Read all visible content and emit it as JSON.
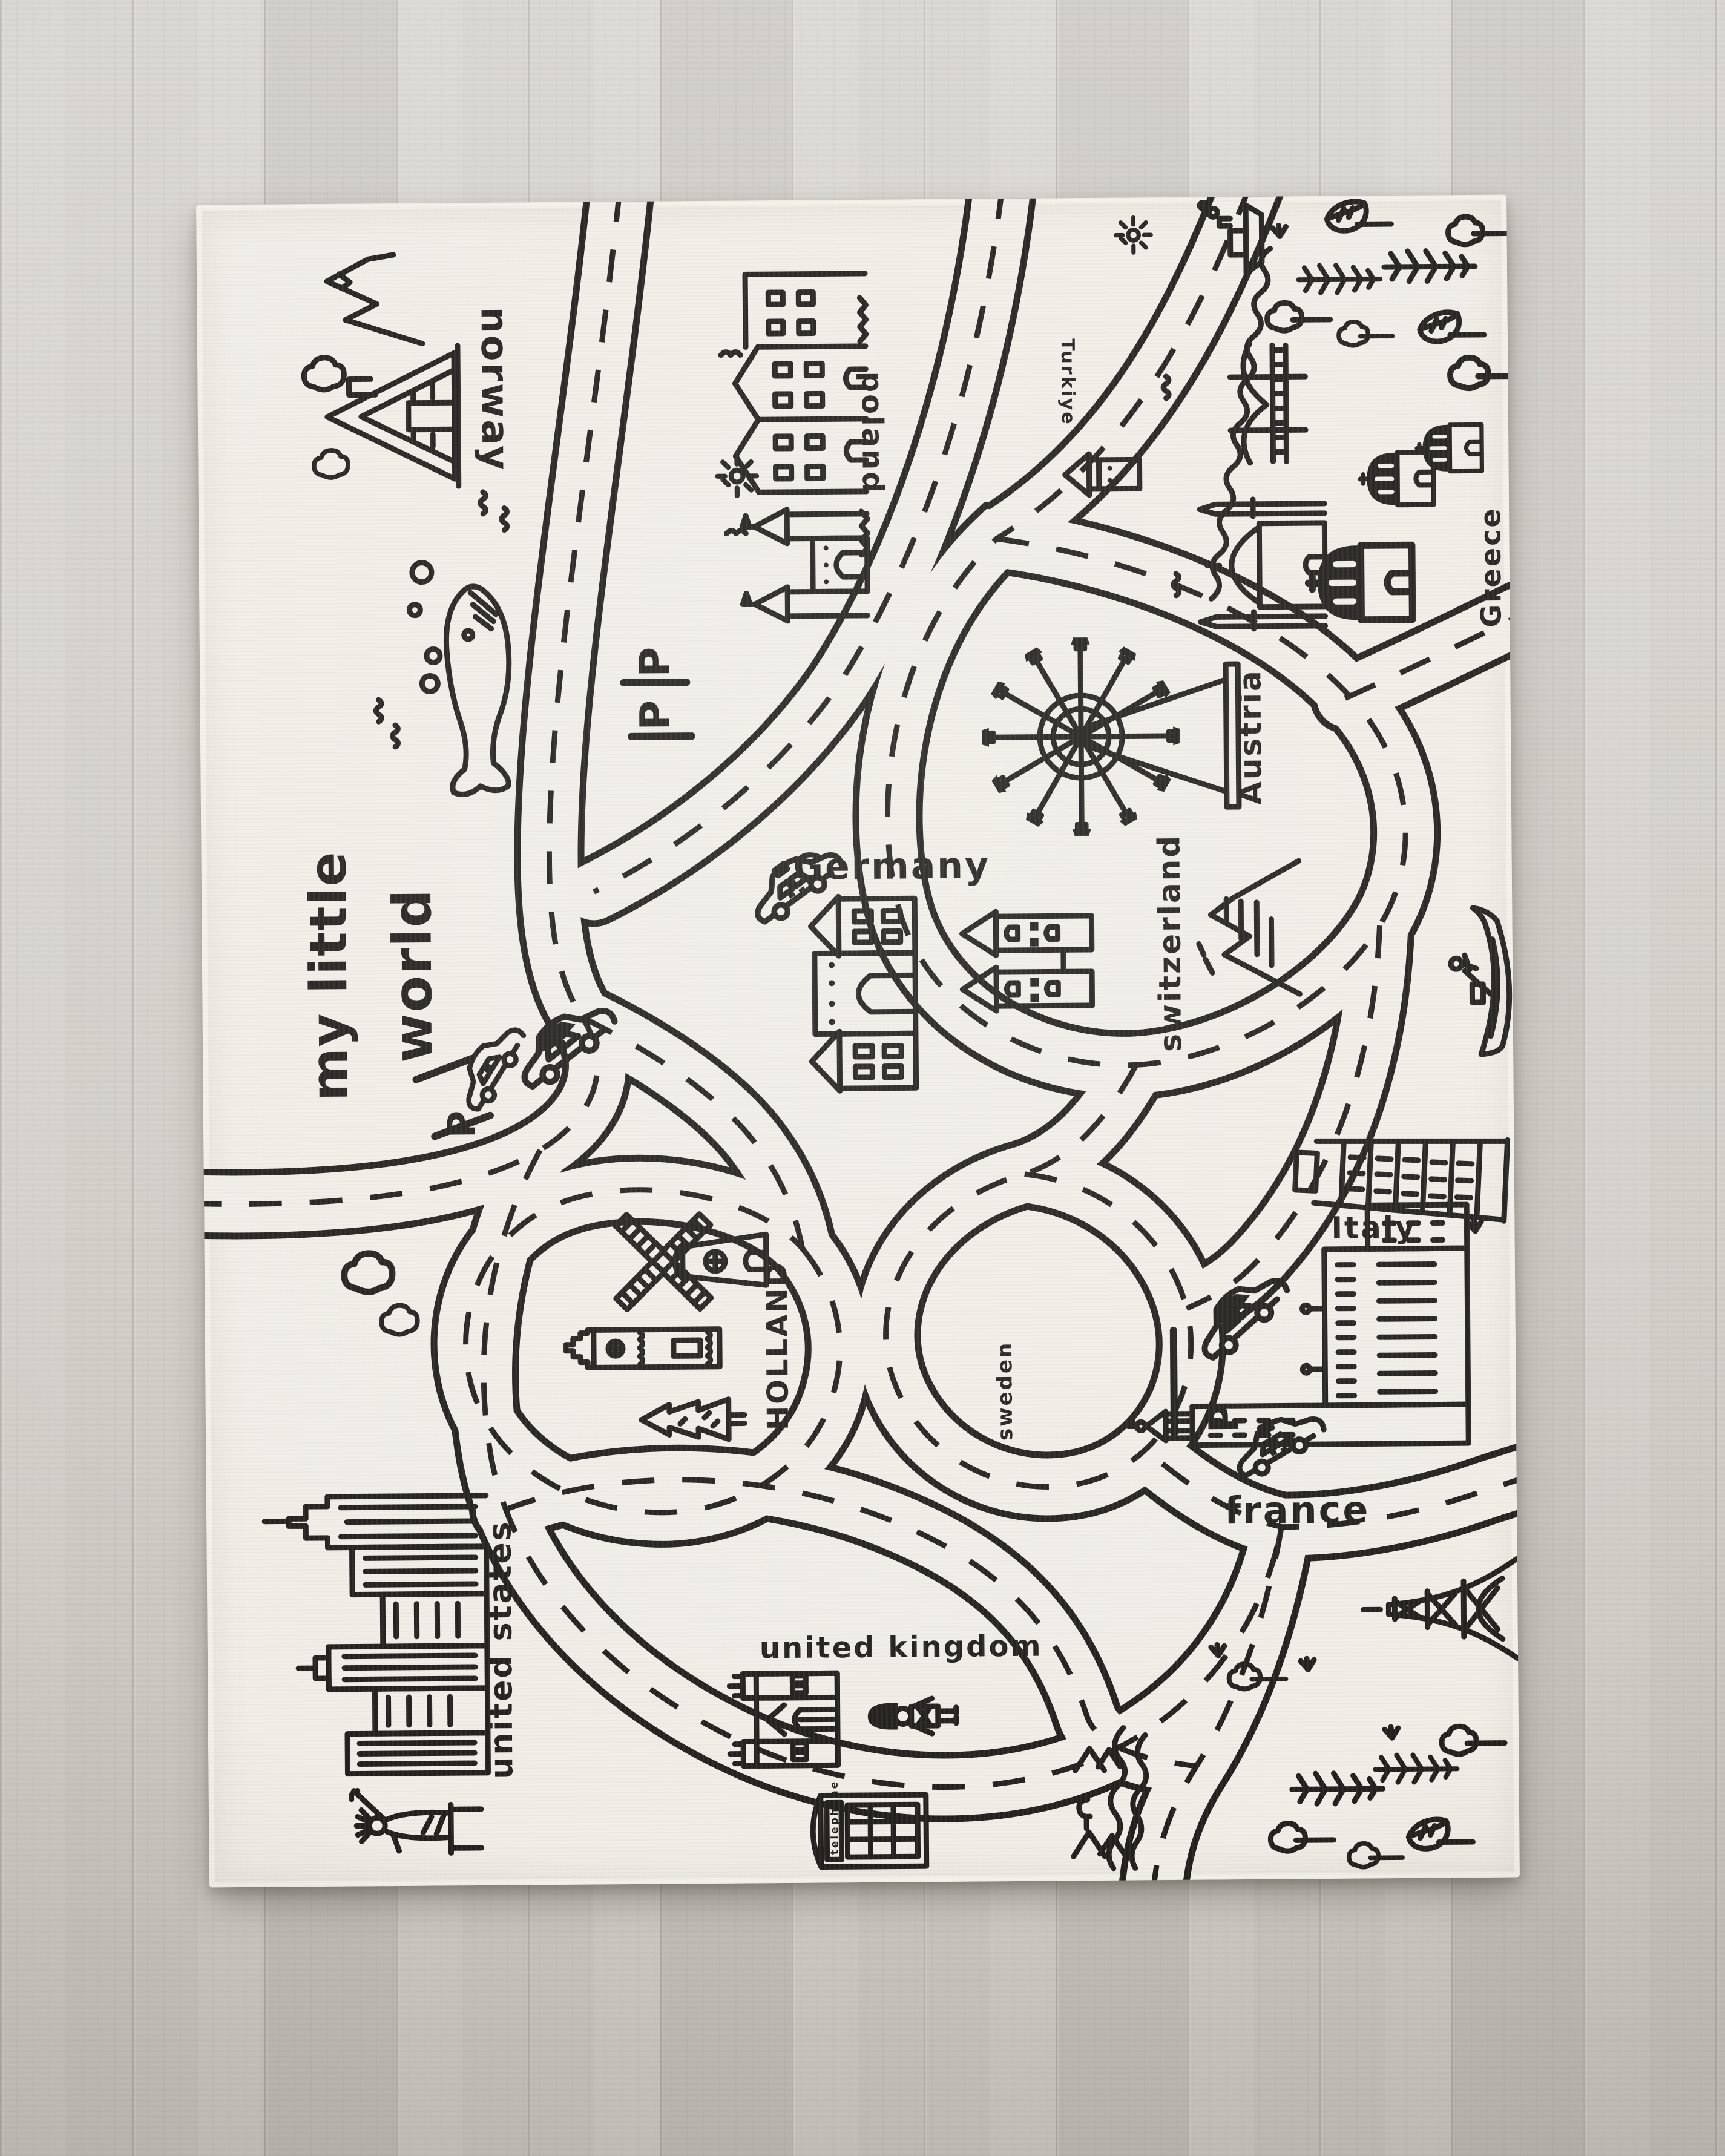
{
  "rug": {
    "title": {
      "line1": "my little",
      "line2": "world"
    },
    "labels": {
      "norway": "norway",
      "poland": "poland",
      "turkiye": "Turkiye",
      "greece": "Greece",
      "austria": "Austria",
      "germany": "Germany",
      "switzerland": "switzerland",
      "italy": "Italy",
      "holland": "HOLLAND",
      "sweden": "sweden",
      "france": "france",
      "united_states": "united states",
      "united_kingdom": "united kingdom"
    },
    "signs": {
      "parking": "P",
      "phone_booth": "telephone"
    },
    "colors": {
      "ink": "#211f1c",
      "rug_base": "#f0eee7",
      "floor": "#d3d0ca"
    }
  }
}
